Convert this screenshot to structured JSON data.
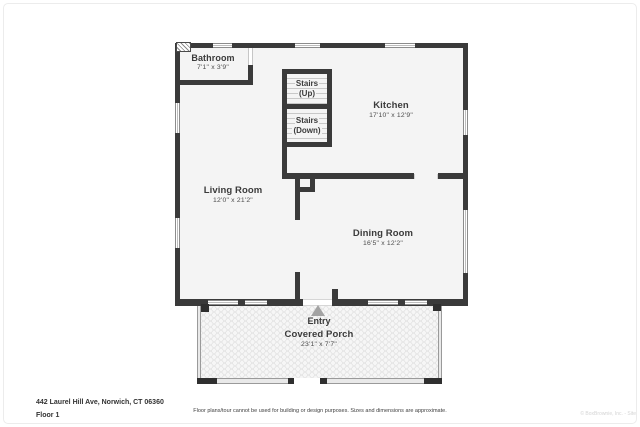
{
  "plan": {
    "wall_color": "#3a3a3a",
    "floor_fill": "#f4f4f4",
    "rooms": [
      {
        "name": "Bathroom",
        "dims": "7'1\" x 3'9\""
      },
      {
        "name": "Kitchen",
        "dims": "17'10\" x 12'9\""
      },
      {
        "name": "Living Room",
        "dims": "12'0\" x 21'2\""
      },
      {
        "name": "Dining Room",
        "dims": "16'5\" x 12'2\""
      }
    ],
    "stairs": [
      {
        "line1": "Stairs",
        "line2": "(Up)"
      },
      {
        "line1": "Stairs",
        "line2": "(Down)"
      }
    ],
    "porch": {
      "entry_label": "Entry",
      "name": "Covered Porch",
      "dims": "23'1\" x 7'7\""
    }
  },
  "footer": {
    "address": "442 Laurel Hill Ave, Norwich, CT 06360",
    "floor_label": "Floor 1",
    "disclaimer": "Floor plans/tour cannot be used for building or design purposes. Sizes and dimensions are approximate.",
    "watermark": "© BoxBrownie, Inc. - Site"
  }
}
